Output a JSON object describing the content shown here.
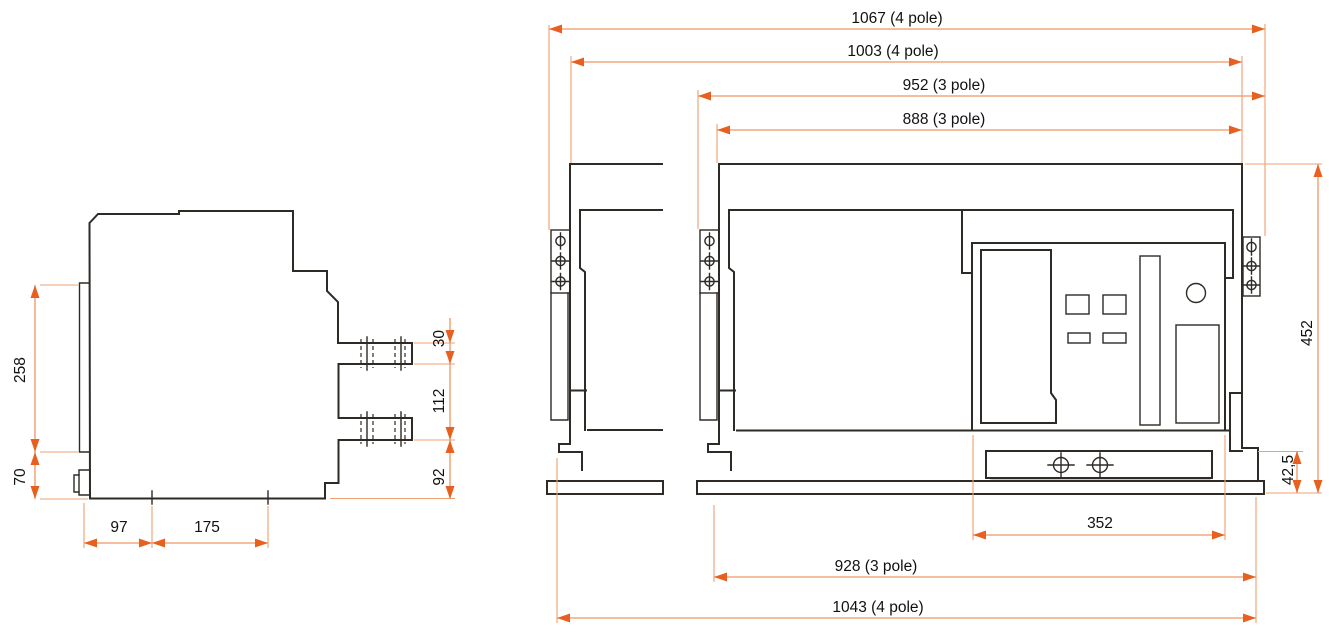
{
  "document_type": "technical-dimension-drawing",
  "subject": "air-circuit-breaker-outline-views",
  "colors": {
    "background": "#ffffff",
    "outline": "#2e2a26",
    "dimension_line": "#ef9464",
    "arrowhead": "#e8601f",
    "text": "#111111"
  },
  "views": {
    "side": {
      "dims": {
        "v258": "258",
        "v70": "70",
        "v97": "97",
        "v175": "175",
        "v30": "30",
        "v112": "112",
        "v92": "92"
      }
    },
    "front": {
      "dims_top": {
        "d1067": "1067 (4 pole)",
        "d1003": "1003 (4 pole)",
        "d952": "952 (3 pole)",
        "d888": "888 (3 pole)"
      },
      "dims_bottom": {
        "d352": "352",
        "d928": "928 (3 pole)",
        "d1043": "1043 (4 pole)"
      },
      "dims_right": {
        "d452": "452",
        "d42_5": "42,5"
      }
    }
  }
}
